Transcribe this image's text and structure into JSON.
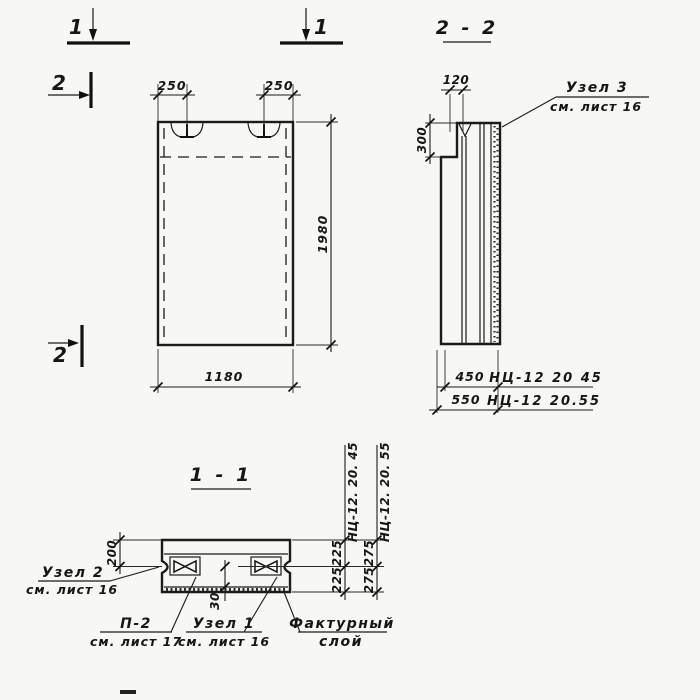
{
  "colors": {
    "paper": "#f7f7f3",
    "ink": "#1b1b1b"
  },
  "markers": {
    "cut1_left": "1",
    "cut1_right": "1",
    "cut2_top": "2",
    "cut2_bottom": "2"
  },
  "elevation": {
    "dim_left_loop": "250",
    "dim_right_loop": "250",
    "dim_height": "1980",
    "dim_width": "1180"
  },
  "section22": {
    "title": "2 - 2",
    "dim_top": "120",
    "dim_step": "300",
    "dim_45": "450",
    "dim_55": "550",
    "mark_45": "НЦ-12 20 45",
    "mark_55": "НЦ-12 20.55",
    "uzel3_title": "Узел 3",
    "uzel3_ref": "см. лист 16"
  },
  "section11": {
    "title": "1 - 1",
    "dim_edge": "200",
    "dim_key": "30",
    "col45_header": "НЦ-12. 20. 45",
    "col45_top": "225",
    "col45_bottom": "225",
    "col55_header": "НЦ-12. 20. 55",
    "col55_top": "275",
    "col55_bottom": "275",
    "uzel2_title": "Узел 2",
    "uzel2_ref": "см. лист 16",
    "p2_title": "П-2",
    "p2_ref": "см. лист 17",
    "uzel1_title": "Узел 1",
    "uzel1_ref": "см. лист 16",
    "facing_line1": "Фактурный",
    "facing_line2": "слой"
  }
}
